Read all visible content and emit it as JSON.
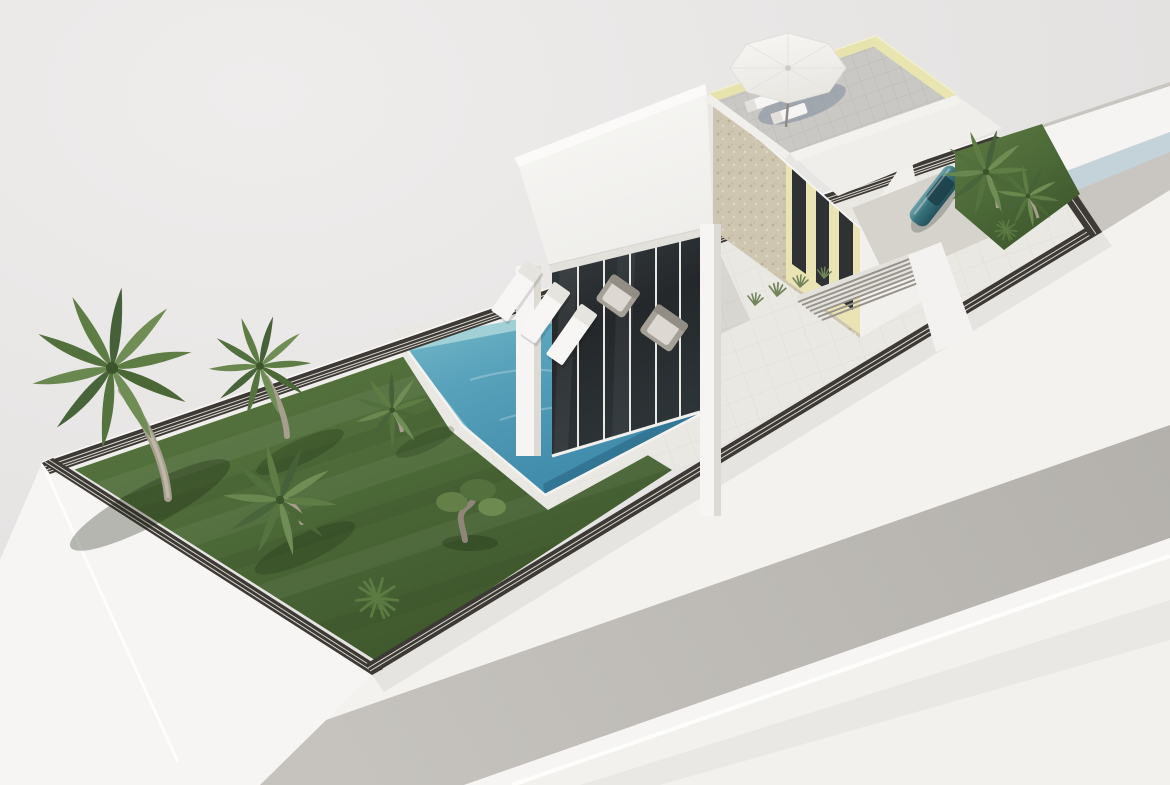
{
  "meta": {
    "title": "Aerial 3D render of a modern villa plot",
    "view": "isometric aerial perspective",
    "text_content": "none"
  },
  "palette": {
    "background": "#e7e5e4",
    "ground": "#f3f2ef",
    "plinth": "#f6f5f4",
    "grass": "#50703c",
    "grass_dark": "#3f582d",
    "deck": "#eae8e3",
    "fence": "#3d3935",
    "fence_gap": "#d8d4ce",
    "white_wall": "#f4f3f1",
    "white_dim": "#e9e7e3",
    "stone": "#cfc6b1",
    "accent_yellow": "#eae4b4",
    "rail_yellow": "#e7e3ad",
    "window_dark": "#2e3234",
    "glass_dark": "#2c3134",
    "pool_light": "#abd6da",
    "pool_mid": "#58a2bb",
    "pool_deep": "#3c86a8",
    "road": "#bdbab5",
    "street": "#c9c6c1",
    "driveway": "#d6d3cd",
    "roof_tile": "#cac8c4",
    "car_teal": "#2f6a74",
    "trunk": "#a69e8e",
    "frond_a": "#5e7d45",
    "frond_b": "#4b6736",
    "frond_c": "#6f8d54"
  },
  "objects": {
    "villa": "white modern flat-roof villa with glass wall and stone-clad side wall",
    "pool": "rectangular swimming pool, turquoise water",
    "rooftop_terrace": "tiled roof solarium with parasol, two loungers and pale yellow glass railing",
    "parasol_count": 1,
    "pool_lounger_count": 3,
    "roof_lounger_count": 2,
    "outdoor_sofa_count": 2,
    "palm_count": 6,
    "bush_count": 2,
    "olive_tree_count": 1,
    "car_count": 1,
    "car_color": "teal",
    "perimeter": "dark louvered slat fence on white plinth walls",
    "road": "grey street along lower-right and behind upper-right corner"
  }
}
